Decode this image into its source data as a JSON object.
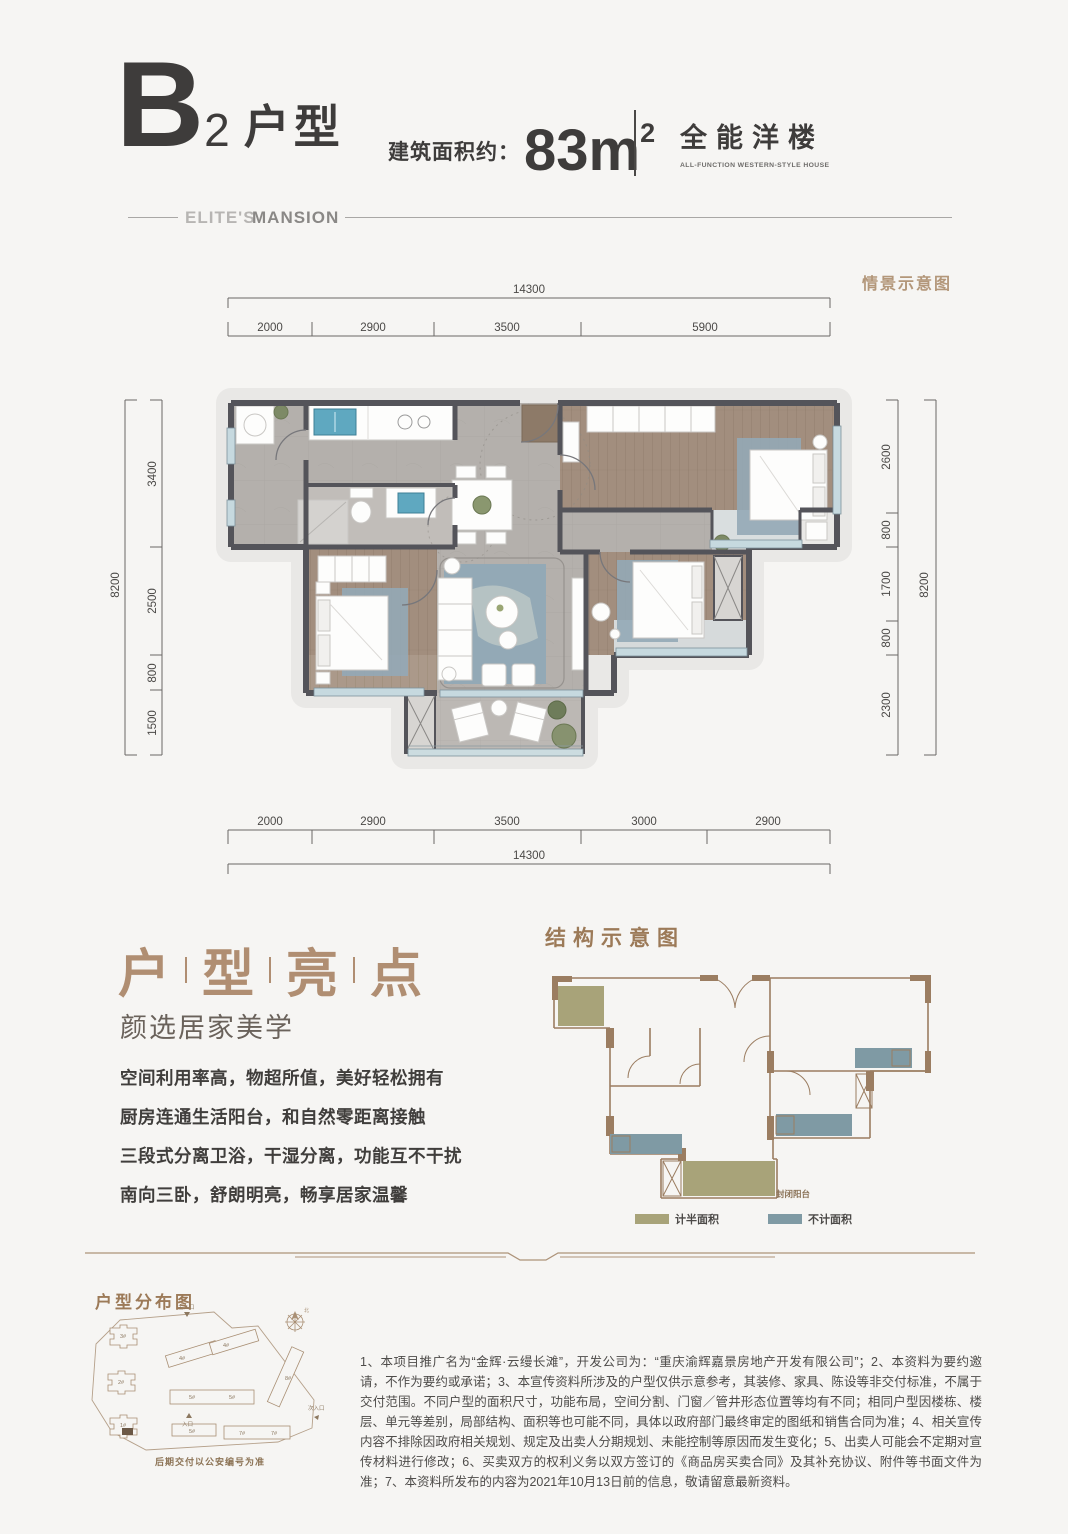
{
  "header": {
    "type_letter": "B",
    "type_number": "2",
    "type_name": "户型",
    "area_label": "建筑面积约：",
    "area_value": "83m",
    "area_sup": "2",
    "category_cn": "全能洋楼",
    "category_en": "ALL-FUNCTION WESTERN-STYLE HOUSE",
    "brand_light": "ELITE'S",
    "brand_bold": "MANSION"
  },
  "plan": {
    "scene_label": "情景示意图",
    "dims": {
      "top_total": "14300",
      "top": [
        "2000",
        "2900",
        "3500",
        "5900"
      ],
      "bottom": [
        "2000",
        "2900",
        "3500",
        "3000",
        "2900"
      ],
      "bottom_total": "14300",
      "left_total": "8200",
      "left": [
        "3400",
        "2500",
        "800",
        "1500"
      ],
      "right": [
        "2600",
        "800",
        "1700",
        "800",
        "2300"
      ],
      "right_total": "8200"
    }
  },
  "highlights": {
    "title": [
      "户",
      "型",
      "亮",
      "点"
    ],
    "subtitle": "颜选居家美学",
    "lines": [
      "空间利用率高，物超所值，美好轻松拥有",
      "厨房连通生活阳台，和自然零距离接触",
      "三段式分离卫浴，干湿分离，功能互不干扰",
      "南向三卧，舒朗明亮，畅享居家温馨"
    ]
  },
  "structure": {
    "title": "结构示意图",
    "balcony_label": "封闭阳台",
    "legend": [
      {
        "label": "计半面积",
        "color": "#a8a379"
      },
      {
        "label": "不计面积",
        "color": "#7f9aa4"
      }
    ]
  },
  "site": {
    "title": "户型分布图",
    "caption": "后期交付以公安编号为准",
    "entrance_top": "主入口",
    "entrance_right": "次入口",
    "entrance_bottom": "入口",
    "compass_north": "北",
    "buildings": [
      "3#",
      "2#",
      "1#",
      "4#",
      "4#",
      "5#",
      "5#",
      "5#",
      "7#",
      "7#",
      "8#"
    ]
  },
  "disclaimer": "1、本项目推广名为“金辉·云缦长滩”，开发公司为：“重庆渝辉嘉景房地产开发有限公司”；2、本资料为要约邀请，不作为要约或承诺；3、本宣传资料所涉及的户型仅供示意参考，其装修、家具、陈设等非交付标准，不属于交付范围。不同户型的面积尺寸，功能布局，空间分割、门窗／管井形态位置等均有不同；相同户型因楼栋、楼层、单元等差别，局部结构、面积等也可能不同，具体以政府部门最终审定的图纸和销售合同为准；4、相关宣传内容不排除因政府相关规划、规定及出卖人分期规划、未能控制等原因而发生变化；5、出卖人可能会不定期对宣传材料进行修改；6、买卖双方的权利义务以双方签订的《商品房买卖合同》及其补充协议、附件等书面文件为准；7、本资料所发布的内容为2021年10月13日前的信息，敬请留意最新资料。",
  "colors": {
    "background": "#f6f5f3",
    "text_dark": "#3e3c3b",
    "accent_brown": "#b3977a",
    "wall": "#54545a",
    "wood_floor": "#a28e7e",
    "tile_floor": "#b4b0ac",
    "rug_blue": "#93a9b6",
    "window_blue": "#c6d9df",
    "struct_wall": "#9b7d61",
    "legend_half": "#a8a379",
    "legend_none": "#7f9aa4"
  }
}
